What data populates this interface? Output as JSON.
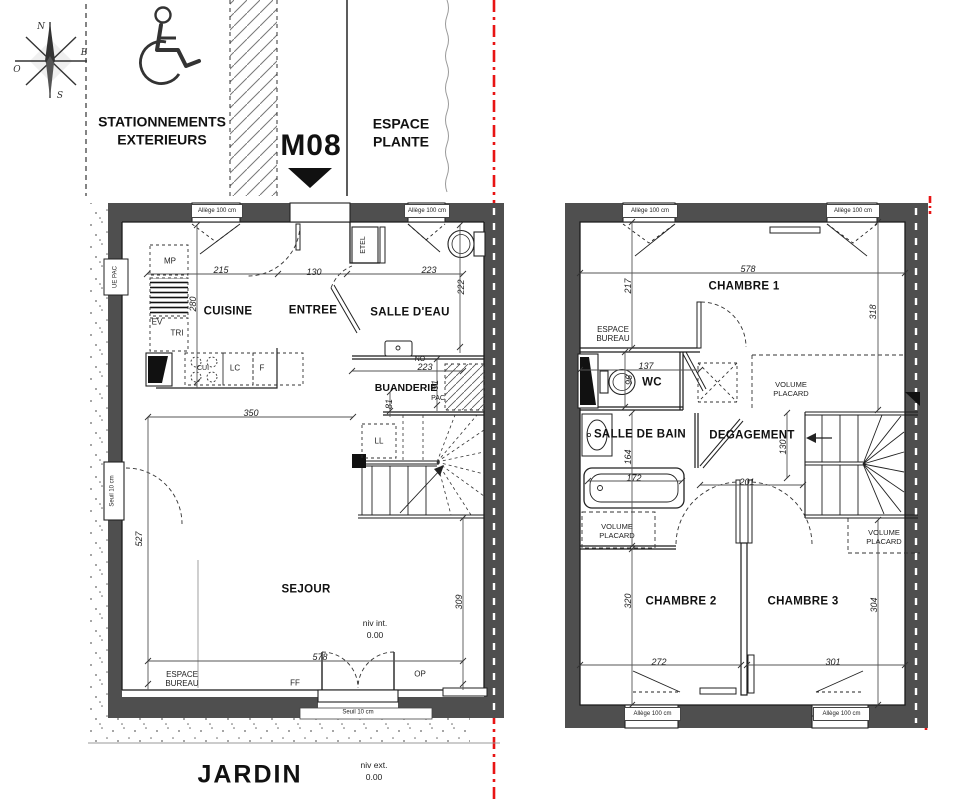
{
  "colors": {
    "wall": "#4f4f4f",
    "line": "#1b1b1b",
    "red": "#e81414",
    "dim_text": "#222222"
  },
  "site": {
    "compass": {
      "north": "N",
      "east": "E",
      "south": "S",
      "west": "O"
    },
    "parking": "STATIONNEMENTS EXTERIEURS",
    "unit": "M08",
    "espace_plante": "ESPACE PLANTE",
    "jardin": "JARDIN",
    "niv_int_label": "niv int.",
    "niv_int_value": "0.00",
    "niv_ext_label": "niv ext.",
    "niv_ext_value": "0.00"
  },
  "common": {
    "allege": "Allège 100 cm",
    "seuil": "Seuil 10 cm",
    "volume_placard": "VOLUME PLACARD",
    "espace_bureau": "ESPACE BUREAU"
  },
  "ground_floor": {
    "rooms": {
      "cuisine": "CUISINE",
      "entree": "ENTREE",
      "salle_deau": "SALLE D'EAU",
      "buanderie": "BUANDERIE",
      "sejour": "SEJOUR"
    },
    "labels": {
      "mp": "MP",
      "ev": "EV",
      "tri": "TRI",
      "cui": "CUI",
      "lc": "LC",
      "f": "F",
      "ll": "LL",
      "no": "NO",
      "pac": "PAC",
      "ue_pac": "UE PAC",
      "etel": "ETEL",
      "ff": "FF",
      "op": "OP"
    },
    "dims": {
      "w_cuisine": "215",
      "w_entree": "130",
      "w_salle_deau": "223",
      "h_cuisine": "280",
      "h_salle_deau": "222",
      "w_buanderie": "223",
      "h_buanderie": "91",
      "h_stair_door": "81",
      "w_mid": "350",
      "h_sejour": "527",
      "w_sejour": "578",
      "h_sejour_right": "309"
    }
  },
  "upper_floor": {
    "rooms": {
      "chambre1": "CHAMBRE 1",
      "chambre2": "CHAMBRE 2",
      "chambre3": "CHAMBRE 3",
      "wc": "WC",
      "salle_de_bain": "SALLE DE BAIN",
      "degagement": "DEGAGEMENT"
    },
    "dims": {
      "w_chambre1": "578",
      "h_left": "217",
      "h_right": "318",
      "w_wc": "137",
      "h_wc": "96",
      "h_sdb": "164",
      "w_bath": "172",
      "h_degagement": "130",
      "w_degagement": "201",
      "h_chambre2": "320",
      "h_chambre3": "304",
      "w_chambre2": "272",
      "w_chambre3": "301"
    }
  }
}
